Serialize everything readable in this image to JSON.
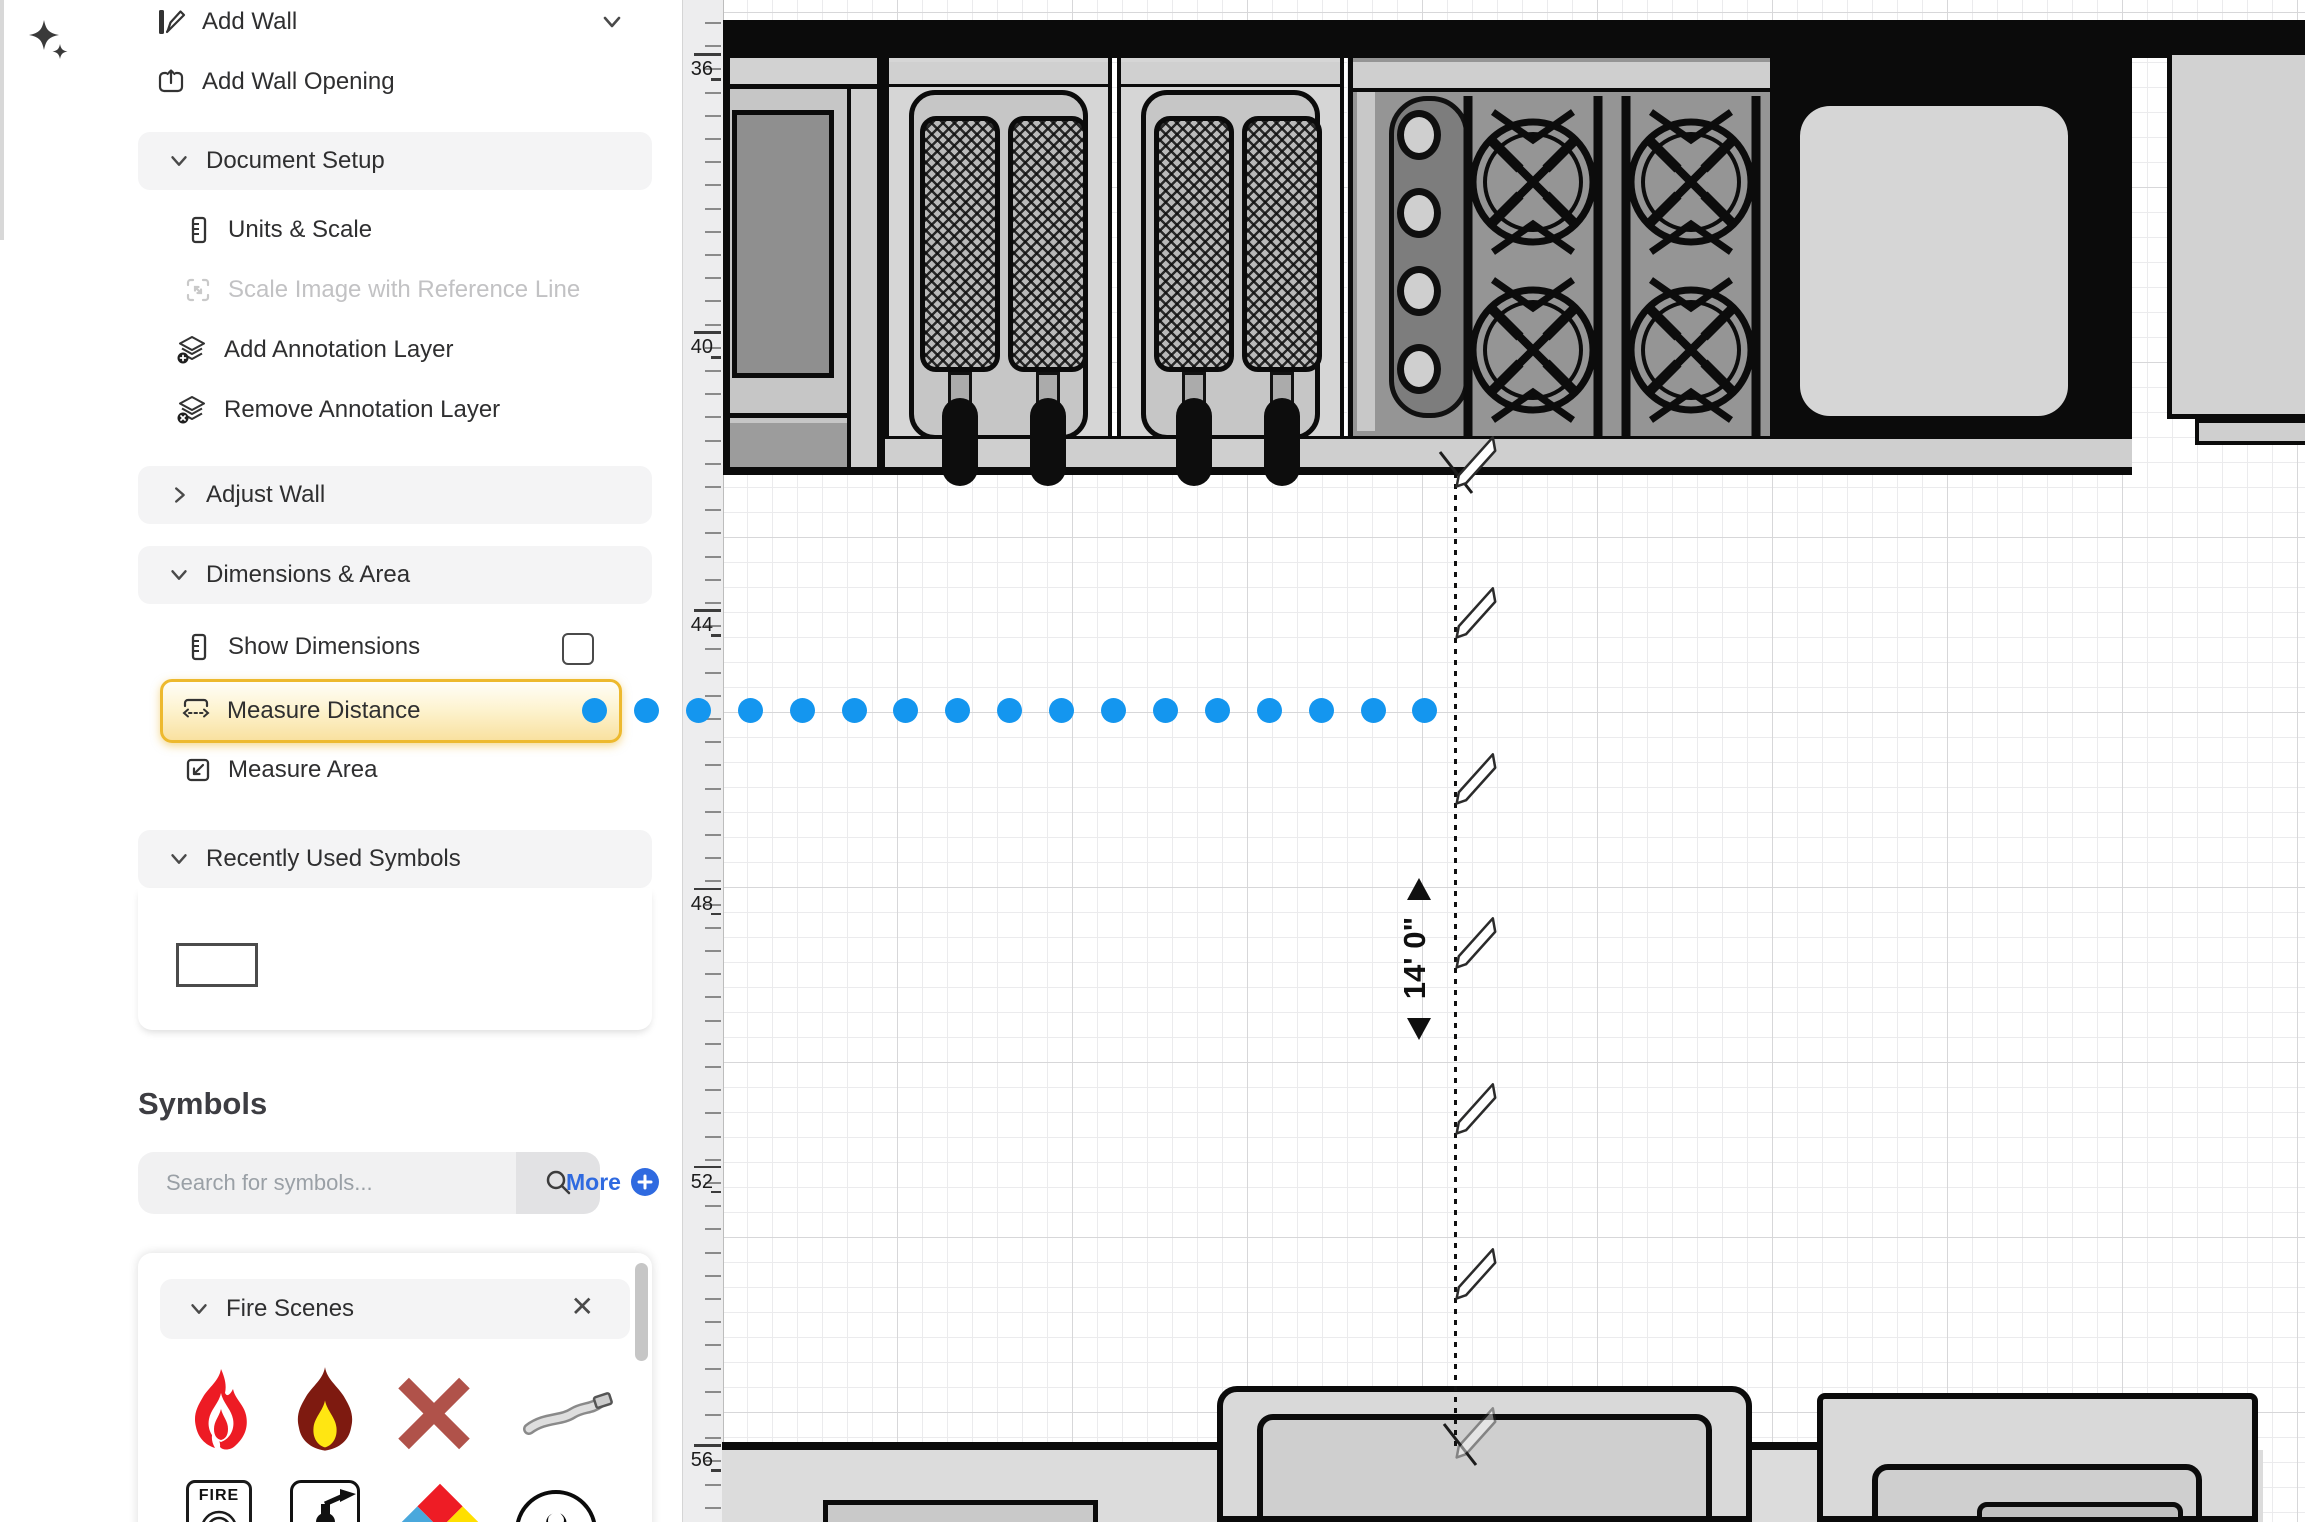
{
  "sidebar": {
    "add_wall": {
      "label": "Add Wall"
    },
    "add_wall_opening": {
      "label": "Add Wall Opening"
    },
    "document_setup": {
      "label": "Document Setup"
    },
    "units_scale": {
      "label": "Units & Scale"
    },
    "scale_image": {
      "label": "Scale Image with Reference Line",
      "enabled": false
    },
    "add_annotation_layer": {
      "label": "Add Annotation Layer"
    },
    "remove_annotation_layer": {
      "label": "Remove Annotation Layer"
    },
    "adjust_wall": {
      "label": "Adjust Wall"
    },
    "dimensions_area": {
      "label": "Dimensions & Area"
    },
    "show_dimensions": {
      "label": "Show Dimensions",
      "checked": false
    },
    "measure_distance": {
      "label": "Measure Distance",
      "active": true
    },
    "measure_area": {
      "label": "Measure Area"
    },
    "recently_used": {
      "label": "Recently Used Symbols"
    },
    "symbols_title": "Symbols",
    "search": {
      "placeholder": "Search for symbols...",
      "value": ""
    },
    "more_label": "More",
    "fire_scenes": {
      "label": "Fire Scenes",
      "symbols": [
        "flame",
        "flame-yellow-core",
        "x-mark",
        "hose",
        "fire-alarm",
        "fire-extinguisher",
        "nfpa-diamond",
        "biohazard"
      ]
    }
  },
  "canvas": {
    "ruler": {
      "labels": [
        "36",
        "40",
        "44",
        "48",
        "52",
        "56"
      ]
    },
    "measurement": {
      "value": "14' 0\""
    },
    "fire_alarm_text": "FIRE",
    "close_glyph": "✕",
    "biohazard_glyph": "☣",
    "colors": {
      "accent_blue": "#1496ef",
      "highlight_border": "#edb92e",
      "link_blue": "#2f6ae0"
    }
  }
}
